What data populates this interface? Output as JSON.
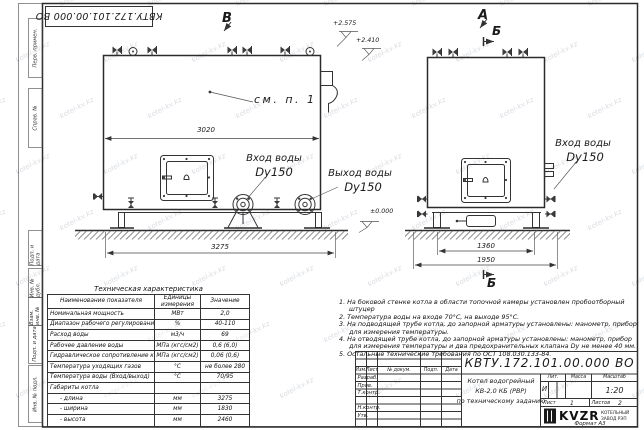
{
  "doc_number": "КВТУ.172.101.00.000 ВО",
  "watermark": "kotel-kv.kz",
  "frame": {
    "side_labels": [
      "Перв. примен.",
      "Справ. №",
      "Подп. и дата",
      "Инв. № дубл.",
      "Взам. инв. №",
      "Подп. и дата",
      "Инв. № подл."
    ]
  },
  "views": {
    "marker_v": "В",
    "marker_a": "А",
    "marker_b_top": "Б",
    "marker_b_bottom": "Б",
    "see_note": "см. п. 1",
    "elevations": {
      "valve_top": "+2.575",
      "boiler_top": "+2.410",
      "ground": "±0.000"
    },
    "dimensions": {
      "body_length": "3020",
      "overall_length": "3275",
      "base_width": "1360",
      "overall_width": "1950"
    },
    "labels": {
      "inlet_title": "Вход воды",
      "inlet_size": "Dy150",
      "outlet_title": "Выход воды",
      "outlet_size": "Dy150",
      "end_inlet_title": "Вход воды",
      "end_inlet_size": "Dy150"
    }
  },
  "spec_table": {
    "title": "Техническая характеристика",
    "headers": [
      "Наименование показателя",
      "Единицы измерения",
      "Значение"
    ],
    "rows": [
      [
        "Номинальная мощность",
        "МВт",
        "2,0"
      ],
      [
        "Диапазон рабочего регулирования",
        "%",
        "40-110"
      ],
      [
        "Расход воды",
        "м3/ч",
        "69"
      ],
      [
        "Рабочее давление воды",
        "МПа (кгс/см2)",
        "0,6 (6,0)"
      ],
      [
        "Гидравлическое сопротивление котла",
        "МПа (кгс/см2)",
        "0,06 (0,6)"
      ],
      [
        "Температура уходящих газов",
        "°С",
        "не более 280"
      ],
      [
        "Температура воды (Вход/выход)",
        "°С",
        "70/95"
      ],
      [
        "Габариты котла",
        "",
        ""
      ],
      [
        "- длина",
        "мм",
        "3275"
      ],
      [
        "- ширина",
        "мм",
        "1830"
      ],
      [
        "- высота",
        "мм",
        "2460"
      ]
    ]
  },
  "notes": [
    "На боковой стенке котла в области топочной камеры установлен пробоотборный штуцер",
    "Температура воды на входе 70°С, на выходе 95°С.",
    "На подводящей трубе котла, до запорной арматуры установлены: манометр, прибор для измерения температуры.",
    "На отводящей трубе котла, до запорной арматуры установлены: манометр, прибор для измерения температуры и два предохранительных клапана Dу не менее 40 мм.",
    "Остальные технические требования по ОСТ 108.030.133-84."
  ],
  "title_block": {
    "doc_number": "КВТУ.172.101.00.000 ВО",
    "rev_headers": [
      "Изм.",
      "Лист",
      "№ докум.",
      "Подп.",
      "Дата"
    ],
    "sign_rows": [
      "Разраб.",
      "Пров.",
      "Т.контр.",
      "",
      "Н.контр.",
      "Утв."
    ],
    "product_name_lines": [
      "Котел водогрейный",
      "КВ-2,0 КБ (РВР)",
      "по техническому заданию"
    ],
    "lit_header": "Лит.",
    "mass_header": "Масса",
    "scale_header": "Масштаб",
    "lit_value": "И",
    "scale_value": "1:20",
    "sheet_label": "Лист",
    "sheet_value": "1",
    "sheets_label": "Листов",
    "sheets_value": "2",
    "logo_text": "KVZR",
    "logo_sub1": "КОТЕЛЬНЫЙ",
    "logo_sub2": "ЗАВОД РЭП",
    "format_label": "Формат  А3"
  }
}
